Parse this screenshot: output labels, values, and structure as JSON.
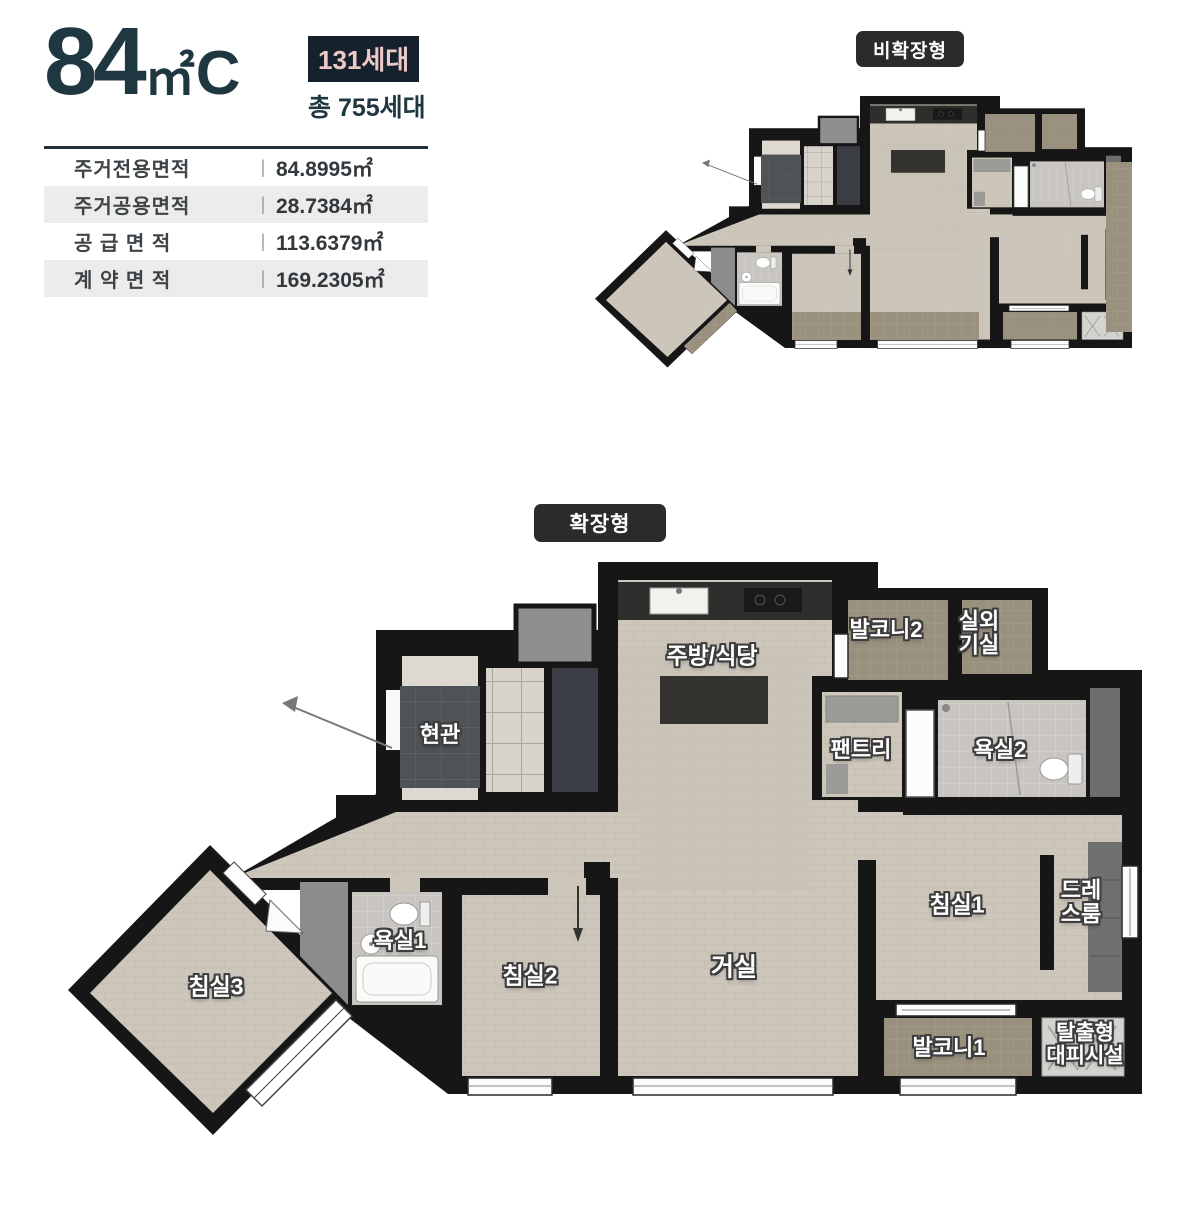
{
  "header": {
    "size_number": "84",
    "size_unit": "㎡",
    "size_suffix": "C",
    "units_badge": "131세대",
    "total_units": "총 755세대"
  },
  "area_table": {
    "rows": [
      {
        "label": "주거전용면적",
        "value": "84.8995㎡"
      },
      {
        "label": "주거공용면적",
        "value": "28.7384㎡"
      },
      {
        "label": "공 급 면 적",
        "value": "113.6379㎡"
      },
      {
        "label": "계 약 면 적",
        "value": "169.2305㎡"
      }
    ]
  },
  "plans": {
    "non_expanded": {
      "badge": "비확장형"
    },
    "expanded": {
      "badge": "확장형",
      "rooms": [
        {
          "id": "kitchen-dining",
          "label": "주방/식당"
        },
        {
          "id": "balcony2",
          "label": "발코니2"
        },
        {
          "id": "outdoor-unit",
          "label": "실외\n기실"
        },
        {
          "id": "entrance",
          "label": "현관"
        },
        {
          "id": "pantry",
          "label": "팬트리"
        },
        {
          "id": "bathroom2",
          "label": "욕실2"
        },
        {
          "id": "bedroom1",
          "label": "침실1"
        },
        {
          "id": "dressroom",
          "label": "드레\n스룸"
        },
        {
          "id": "bathroom1",
          "label": "욕실1"
        },
        {
          "id": "bedroom2",
          "label": "침실2"
        },
        {
          "id": "living",
          "label": "거실"
        },
        {
          "id": "bedroom3",
          "label": "침실3"
        },
        {
          "id": "balcony1",
          "label": "발코니1"
        },
        {
          "id": "escape",
          "label": "탈출형\n대피시설"
        }
      ]
    }
  },
  "colors": {
    "accent_dark": "#1f3740",
    "units_badge_bg": "#15222e",
    "units_badge_text": "#edcac6",
    "plan_badge_bg": "#2b2b2b",
    "wall": "#161616",
    "floor": "#cdc6ba",
    "balcony_tile": "#99917e",
    "entry_tile": "#4e5357",
    "bath_tile": "#c8c5c0",
    "table_alt_row": "#ececec"
  }
}
